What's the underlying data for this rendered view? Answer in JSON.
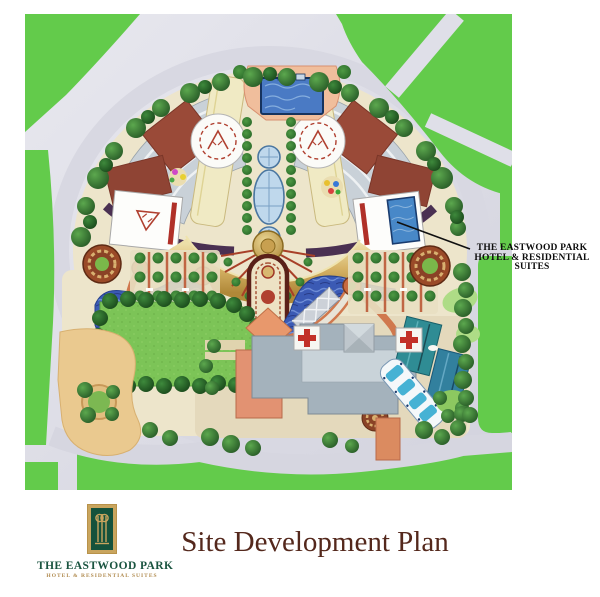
{
  "document": {
    "kind": "site development plan presentation page",
    "background": "#ffffff"
  },
  "plan": {
    "callout": {
      "lines": [
        "THE EASTWOOD PARK",
        "HOTEL & RESIDENTIAL",
        "SUITES"
      ]
    }
  },
  "footer": {
    "title": "Site Development Plan",
    "logo": {
      "name": "THE EASTWOOD PARK",
      "tagline": "HOTEL & RESIDENTIAL SUITES"
    }
  },
  "colors": {
    "street_green": "#63cb4b",
    "lawn_green": "#7cc457",
    "tree_green": "#1e5b26",
    "road_gray": "#dfdfe8",
    "water_blue": "#3b5ab4",
    "pool_blue": "#4a7ac4",
    "cream_site": "#ede5cb",
    "cream_tower": "#f0eac4",
    "gold_canopy": "#d6b366",
    "roof_red": "#9a4a38",
    "roof_teal": "#2e8c94",
    "roof_orange": "#e29272",
    "roof_gray": "#a4b2bc",
    "deck_peach": "#f0be9c",
    "sand_tan": "#eac98f",
    "medallion_brown": "#8a4226",
    "title_brown": "#54281c",
    "logo_green": "#14523c",
    "logo_gold": "#c9a55e",
    "callout_text": "#0c0c0c"
  }
}
